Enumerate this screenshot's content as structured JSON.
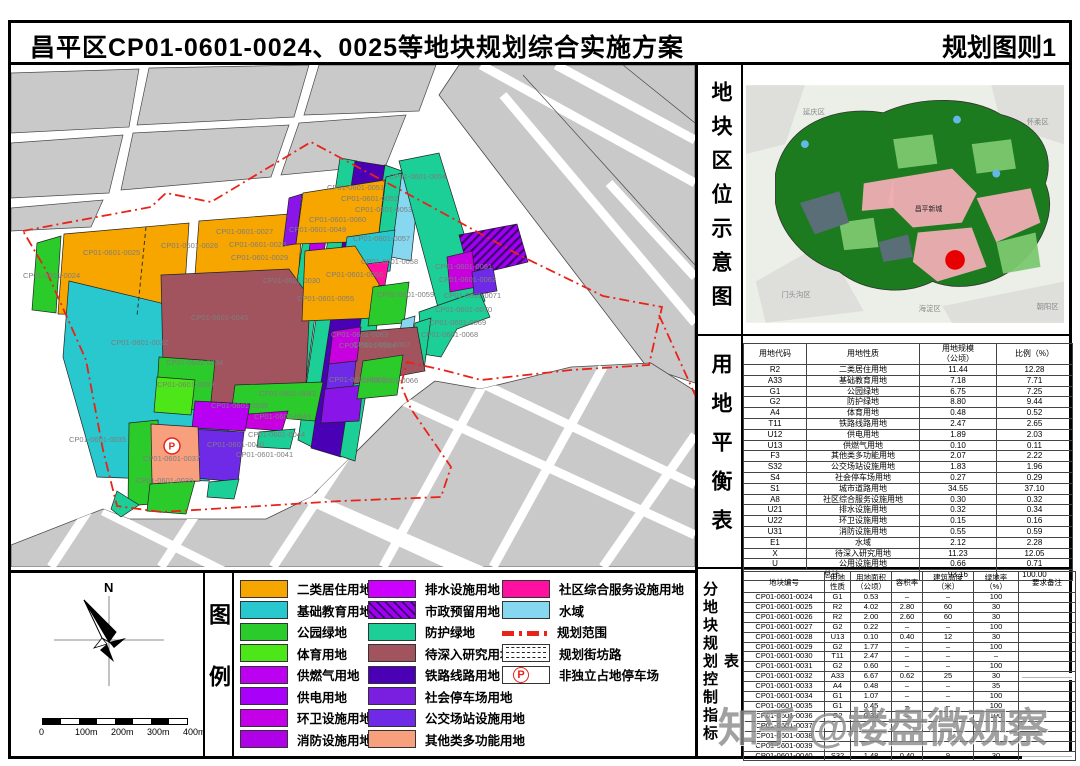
{
  "header": {
    "title": "昌平区CP01-0601-0024、0025等地块规划综合实施方案",
    "sheet_label": "规划图则1"
  },
  "watermark": {
    "text": "知乎 @楼盘微观察"
  },
  "location_panel": {
    "side_label": "地块区位示意图",
    "region_labels": [
      {
        "t": "延庆区",
        "x": 58,
        "y": 30,
        "dark": false
      },
      {
        "t": "怀柔区",
        "x": 286,
        "y": 40,
        "dark": false
      },
      {
        "t": "门头沟区",
        "x": 36,
        "y": 216,
        "dark": false
      },
      {
        "t": "海淀区",
        "x": 176,
        "y": 230,
        "dark": false
      },
      {
        "t": "朝阳区",
        "x": 296,
        "y": 228,
        "dark": false
      },
      {
        "t": "昌平新城",
        "x": 172,
        "y": 128,
        "dark": true
      }
    ]
  },
  "balance_table": {
    "side_label": "用地平衡表",
    "headers": [
      "用地代码",
      "用地性质",
      "用地规模\n（公顷）",
      "比例（%）"
    ],
    "rows": [
      [
        "R2",
        "二类居住用地",
        "11.44",
        "12.28"
      ],
      [
        "A33",
        "基础教育用地",
        "7.18",
        "7.71"
      ],
      [
        "G1",
        "公园绿地",
        "6.75",
        "7.25"
      ],
      [
        "G2",
        "防护绿地",
        "8.80",
        "9.44"
      ],
      [
        "A4",
        "体育用地",
        "0.48",
        "0.52"
      ],
      [
        "T11",
        "铁路线路用地",
        "2.47",
        "2.65"
      ],
      [
        "U12",
        "供电用地",
        "1.89",
        "2.03"
      ],
      [
        "U13",
        "供燃气用地",
        "0.10",
        "0.11"
      ],
      [
        "F3",
        "其他类多功能用地",
        "2.07",
        "2.22"
      ],
      [
        "S32",
        "公交场站设施用地",
        "1.83",
        "1.96"
      ],
      [
        "S4",
        "社会停车场用地",
        "0.27",
        "0.29"
      ],
      [
        "S1",
        "城市道路用地",
        "34.55",
        "37.10"
      ],
      [
        "A8",
        "社区综合服务设施用地",
        "0.30",
        "0.32"
      ],
      [
        "U21",
        "排水设施用地",
        "0.32",
        "0.34"
      ],
      [
        "U22",
        "环卫设施用地",
        "0.15",
        "0.16"
      ],
      [
        "U31",
        "消防设施用地",
        "0.55",
        "0.59"
      ],
      [
        "E1",
        "水域",
        "2.12",
        "2.28"
      ],
      [
        "X",
        "待深入研究用地",
        "11.23",
        "12.05"
      ],
      [
        "U",
        "公用设施用地",
        "0.66",
        "0.71"
      ]
    ],
    "total_row": [
      "总计",
      "93.16",
      "100.00"
    ]
  },
  "control_table": {
    "side_label": "分地块规划控制指标表",
    "headers": [
      "地块编号",
      "用地\n性质",
      "用地面积\n（公顷）",
      "容积率",
      "建筑高度\n（米）",
      "绿地率\n（%）",
      "要求备注"
    ],
    "rows": [
      [
        "CP01-0601-0024",
        "G1",
        "0.53",
        "–",
        "–",
        "100",
        ""
      ],
      [
        "CP01-0601-0025",
        "R2",
        "4.02",
        "2.80",
        "60",
        "30",
        ""
      ],
      [
        "CP01-0601-0026",
        "R2",
        "2.00",
        "2.60",
        "60",
        "30",
        ""
      ],
      [
        "CP01-0601-0027",
        "G2",
        "0.22",
        "–",
        "–",
        "100",
        ""
      ],
      [
        "CP01-0601-0028",
        "U13",
        "0.10",
        "0.40",
        "12",
        "30",
        ""
      ],
      [
        "CP01-0601-0029",
        "G2",
        "1.77",
        "–",
        "–",
        "100",
        ""
      ],
      [
        "CP01-0601-0030",
        "T11",
        "2.47",
        "–",
        "–",
        "–",
        ""
      ],
      [
        "CP01-0601-0031",
        "G2",
        "0.60",
        "–",
        "–",
        "100",
        ""
      ],
      [
        "CP01-0601-0032",
        "A33",
        "6.67",
        "0.62",
        "25",
        "30",
        ""
      ],
      [
        "CP01-0601-0033",
        "A4",
        "0.48",
        "–",
        "–",
        "35",
        ""
      ],
      [
        "CP01-0601-0034",
        "G1",
        "1.07",
        "–",
        "–",
        "100",
        ""
      ],
      [
        "CP01-0601-0035",
        "G1",
        "0.45",
        "–",
        "–",
        "100",
        ""
      ],
      [
        "CP01-0601-0036",
        "G2",
        "0.33",
        "–",
        "–",
        "100",
        ""
      ],
      [
        "CP01-0601-0037",
        "",
        "",
        "",
        "",
        "",
        ""
      ],
      [
        "CP01-0601-0038",
        "",
        "",
        "",
        "",
        "",
        ""
      ],
      [
        "CP01-0601-0039",
        "",
        "",
        "",
        "",
        "",
        ""
      ],
      [
        "CP01-0601-0040",
        "S32",
        "1.48",
        "0.40",
        "9",
        "30",
        ""
      ]
    ],
    "blur_remark_rows": [
      8,
      16
    ]
  },
  "legend": {
    "section_label": "图例",
    "north_label": "N",
    "scale_labels": [
      "0",
      "100m",
      "200m",
      "300m",
      "400m"
    ],
    "columns": [
      {
        "items": [
          {
            "label": "二类居住用地",
            "color": "#F7A600"
          },
          {
            "label": "基础教育用地",
            "color": "#29C7CE"
          },
          {
            "label": "公园绿地",
            "color": "#2BCB2B"
          },
          {
            "label": "体育用地",
            "color": "#4DE619"
          },
          {
            "label": "供燃气用地",
            "color": "#BC00F0"
          },
          {
            "label": "供电用地",
            "color": "#A800F8"
          },
          {
            "label": "环卫设施用地",
            "color": "#C400E8"
          },
          {
            "label": "消防设施用地",
            "color": "#B000E8"
          }
        ]
      },
      {
        "items": [
          {
            "label": "排水设施用地",
            "color": "#CC00FF"
          },
          {
            "label": "市政预留用地",
            "color": "#9900E6",
            "type": "hatch"
          },
          {
            "label": "防护绿地",
            "color": "#1BCF96"
          },
          {
            "label": "待深入研究用地",
            "color": "#A2545E"
          },
          {
            "label": "铁路线路用地",
            "color": "#4A00B4"
          },
          {
            "label": "社会停车场用地",
            "color": "#7A1FE0"
          },
          {
            "label": "公交场站设施用地",
            "color": "#6F2AE8"
          },
          {
            "label": "其他类多功能用地",
            "color": "#F89F7E"
          }
        ]
      },
      {
        "items": [
          {
            "label": "社区综合服务设施用地",
            "color": "#FF10A0"
          },
          {
            "label": "水域",
            "color": "#86D7F0"
          },
          {
            "label": "规划范围",
            "type": "boundary"
          },
          {
            "label": "规划街坊路",
            "type": "road"
          },
          {
            "label": "非独立占地停车场",
            "type": "parking"
          }
        ]
      }
    ]
  },
  "map": {
    "boundary_color": "#E8231A",
    "boundary_path": "M12,166 L70,155 L140,142 L155,128 L200,137 L300,77 L410,136 L512,192 L592,231 L651,242 L638,300 L560,305 L470,315 L432,305 L396,297 L390,320 L400,344 L440,402 L430,432 L330,436 L250,441 L150,447 L106,441 L92,385 L75,295 L35,205 Z",
    "boundary_extra": "M648,250 L685,332",
    "inner_dashed_line": "M135,162 L126,251",
    "p_marker": [
      161,
      381
    ],
    "parcels": [
      {
        "t": "CP01-0601-0024",
        "c": "#2BCB2B",
        "p": "26,178 50,171 45,248 21,245",
        "l": [
          12,
          213
        ]
      },
      {
        "t": "CP01-0601-0025",
        "c": "#F7A600",
        "p": "53,169 178,158 172,252 47,249",
        "l": [
          72,
          190
        ]
      },
      {
        "t": "CP01-0601-0026",
        "c": "#F7A600",
        "p": "188,156 292,148 287,217 183,223",
        "l": [
          150,
          183
        ]
      },
      {
        "t": "CP01-0601-0027",
        "c": "#1BCF96",
        "p": "296,147 318,143 306,228 285,223",
        "l": [
          205,
          169
        ]
      },
      {
        "t": "CP01-0601-0028",
        "c": "#B800F2",
        "p": "300,172 316,169 312,192 297,194",
        "l": [
          218,
          182
        ]
      },
      {
        "t": "CP01-0601-0029",
        "c": "#1BCF96",
        "p": "283,225 307,230 293,330 270,323",
        "l": [
          220,
          195
        ]
      },
      {
        "t": "",
        "c": "#1BCF96",
        "p": "329,93 346,96 301,382 287,375"
      },
      {
        "t": "CP01-0601-0030",
        "c": "#4A00B4",
        "p": "344,96 376,101 330,392 300,383",
        "l": [
          252,
          218
        ]
      },
      {
        "t": "",
        "c": "#1BCF96",
        "p": "374,100 391,106 344,396 329,391"
      },
      {
        "t": "CP01-0601-0032",
        "c": "#29C7CE",
        "p": "58,216 150,238 224,350 198,416 86,412 52,292",
        "l": [
          100,
          280
        ]
      },
      {
        "t": "CP01-0601-0045",
        "c": "#A2545E",
        "p": "150,210 278,204 299,233 295,318 255,330 224,356 152,300",
        "l": [
          180,
          255
        ]
      },
      {
        "t": "CP01-0601-0034",
        "c": "#2BCB2B",
        "p": "148,292 204,296 199,346 145,342",
        "l": [
          155,
          300
        ]
      },
      {
        "t": "CP01-0601-0033",
        "c": "#4DE619",
        "p": "146,312 184,315 180,350 143,347",
        "l": [
          146,
          322
        ]
      },
      {
        "t": "CP01-0601-0042",
        "c": "#2BCB2B",
        "p": "224,320 312,317 304,356 220,349",
        "l": [
          248,
          331
        ]
      },
      {
        "t": "CP01-0601-0043",
        "c": "#C800E0",
        "p": "237,349 277,346 271,366 234,363",
        "l": [
          243,
          354
        ]
      },
      {
        "t": "CP01-0601-0044",
        "c": "#1BCF96",
        "p": "248,367 284,364 279,384 246,382",
        "l": [
          237,
          372
        ]
      },
      {
        "t": "CP01-0601-0039",
        "c": "#B800F2",
        "p": "184,336 239,339 234,366 181,363",
        "l": [
          200,
          343
        ]
      },
      {
        "t": "CP01-0601-0040",
        "c": "#6F2AE8",
        "p": "179,364 233,367 227,417 174,412",
        "l": [
          196,
          382
        ]
      },
      {
        "t": "CP01-0601-0041",
        "c": "#1BCF96",
        "p": "198,417 228,414 223,434 196,432",
        "l": [
          225,
          392
        ]
      },
      {
        "t": "CP01-0601-0035",
        "c": "#2BCB2B",
        "p": "118,358 147,355 151,438 117,441",
        "l": [
          58,
          377
        ]
      },
      {
        "t": "",
        "c": "#1BCF96",
        "p": "106,426 128,440 110,452 100,444"
      },
      {
        "t": "CP01-0601-0037",
        "c": "#F89F7E",
        "p": "140,359 187,362 189,416 141,419",
        "l": [
          132,
          396
        ]
      },
      {
        "t": "CP01-0601-0038",
        "c": "#2BCB2B",
        "p": "139,419 184,416 175,449 136,446",
        "l": [
          125,
          418
        ]
      },
      {
        "t": "CP01-0601-0049",
        "c": "#8A15E8",
        "p": "278,133 291,129 285,179 272,181",
        "l": [
          278,
          167
        ]
      },
      {
        "t": "CP01-0601-0060",
        "c": "#F7A600",
        "p": "292,128 374,115 367,176 285,179",
        "l": [
          298,
          157
        ]
      },
      {
        "t": "CP01-0601-0051",
        "c": "",
        "p": "",
        "l": [
          316,
          125
        ]
      },
      {
        "t": "CP01-0601-0052",
        "c": "#1BCF96",
        "p": "375,112 391,108 381,191 365,193",
        "l": [
          330,
          136
        ]
      },
      {
        "t": "CP01-0601-0053",
        "c": "#86D7F0",
        "p": "391,107 410,102 400,196 380,192",
        "l": [
          344,
          147
        ]
      },
      {
        "t": "CP01-0601-0054",
        "c": "#1BCF96",
        "p": "388,96 428,88 474,236 430,254",
        "l": [
          378,
          114
        ]
      },
      {
        "t": "CP01-0601-0057",
        "c": "#29C7CE",
        "p": "336,172 384,165 379,206 331,211",
        "l": [
          342,
          176
        ]
      },
      {
        "t": "CP01-0601-0058",
        "c": "#FF10A0",
        "p": "348,200 378,196 374,220 345,224",
        "l": [
          350,
          199
        ]
      },
      {
        "t": "CP01-0601-0056",
        "c": "#F7A600",
        "p": "294,186 344,181 368,219 363,253 291,256",
        "l": [
          315,
          212
        ]
      },
      {
        "t": "CP01-0601-0055",
        "c": "",
        "p": "",
        "l": [
          286,
          236
        ]
      },
      {
        "t": "CP01-0601-0059",
        "c": "#2BCB2B",
        "p": "362,222 398,217 393,258 357,261",
        "l": [
          366,
          232
        ]
      },
      {
        "t": "CP01-0601-0071",
        "c": "#1BCF96",
        "p": "408,247 468,226 479,252 446,264 430,292 411,289",
        "l": [
          433,
          233
        ]
      },
      {
        "t": "CP01-0601-0070",
        "c": "",
        "p": "",
        "l": [
          424,
          247
        ]
      },
      {
        "t": "CP01-0601-0069",
        "c": "#1BCF96",
        "p": "404,258 420,253 413,305 398,302",
        "l": [
          418,
          260
        ]
      },
      {
        "t": "CP01-0601-0068",
        "c": "#86D7F0",
        "p": "391,255 404,251 397,300 384,296",
        "l": [
          410,
          272
        ]
      },
      {
        "t": "CP01-0601-0067",
        "c": "#A2545E",
        "p": "330,268 406,262 414,306 338,320",
        "l": [
          342,
          282
        ]
      },
      {
        "t": "CP01-0601-0063",
        "c": "#C800E0",
        "p": "322,266 350,262 346,296 318,299",
        "l": [
          320,
          272
        ]
      },
      {
        "t": "CP01-0601-0064",
        "c": "#6F2AE8",
        "p": "318,299 345,296 342,322 315,324",
        "l": [
          328,
          283
        ]
      },
      {
        "t": "CP01-0601-0065",
        "c": "#8A15E8",
        "p": "314,324 352,320 348,356 310,358",
        "l": [
          318,
          317
        ]
      },
      {
        "t": "CP01-0601-0066",
        "c": "#2BCB2B",
        "p": "352,296 392,290 386,330 346,334",
        "l": [
          350,
          318
        ]
      },
      {
        "t": "",
        "c": "hatch",
        "p": "448,170 506,159 517,197 459,211"
      },
      {
        "t": "CP01-0601-0061",
        "c": "#C800E0",
        "p": "436,192 461,186 466,222 439,227",
        "l": [
          424,
          204
        ]
      },
      {
        "t": "CP01-0601-0062",
        "c": "#6F2AE8",
        "p": "461,207 482,202 486,226 463,230",
        "l": [
          428,
          217
        ]
      }
    ]
  }
}
